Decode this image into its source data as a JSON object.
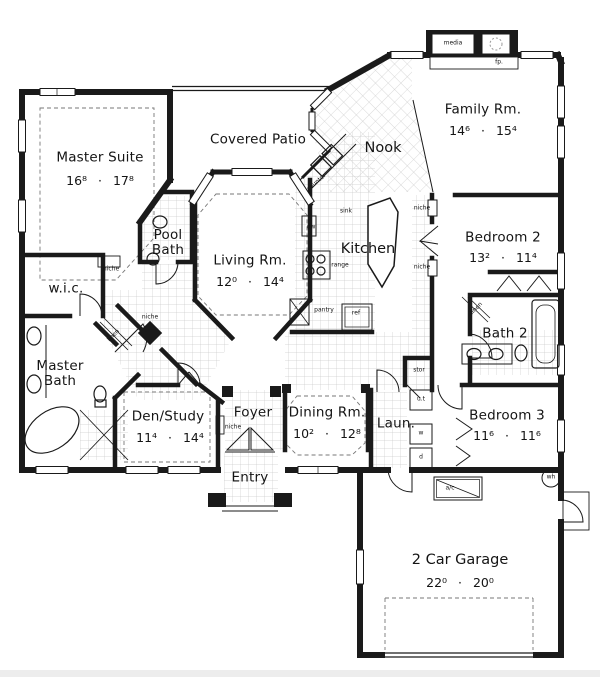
{
  "colors": {
    "wall": "#1a1a1a",
    "background": "#ffffff",
    "tile_grid": "#c9c9c9",
    "dashed_ceiling": "#777777"
  },
  "rooms": {
    "master_suite": {
      "label": "Master Suite",
      "dim": "16⁸ · 17⁸"
    },
    "covered_patio": {
      "label": "Covered Patio"
    },
    "nook": {
      "label": "Nook"
    },
    "family_rm": {
      "label": "Family Rm.",
      "dim": "14⁶ · 15⁴"
    },
    "pool_bath": {
      "label": "Pool Bath"
    },
    "wic": {
      "label": "w.i.c."
    },
    "living_rm": {
      "label": "Living Rm.",
      "dim": "12⁰ · 14⁴"
    },
    "kitchen": {
      "label": "Kitchen"
    },
    "bedroom2": {
      "label": "Bedroom 2",
      "dim": "13² · 11⁴"
    },
    "bath2": {
      "label": "Bath 2"
    },
    "master_bath": {
      "label": "Master Bath"
    },
    "den_study": {
      "label": "Den/Study",
      "dim": "11⁴ · 14⁴"
    },
    "foyer": {
      "label": "Foyer"
    },
    "entry": {
      "label": "Entry"
    },
    "dining_rm": {
      "label": "Dining Rm.",
      "dim": "10² · 12⁸"
    },
    "laundry": {
      "label": "Laun."
    },
    "bedroom3": {
      "label": "Bedroom 3",
      "dim": "11⁶ · 11⁶"
    },
    "garage": {
      "label": "2 Car Garage",
      "dim": "22⁰ · 20⁰"
    }
  },
  "annotations": {
    "media": "media",
    "fp": "fp.",
    "counter": "counter",
    "sink": "sink",
    "dw": "dw",
    "range": "range",
    "pantry": "pantry",
    "ref": "ref",
    "niche": "niche",
    "linen": "linen",
    "stor": "stor",
    "utility_tub": "u.t",
    "washer": "w",
    "dryer": "d",
    "ac_unit": "a/c",
    "water_heater": "wh"
  }
}
